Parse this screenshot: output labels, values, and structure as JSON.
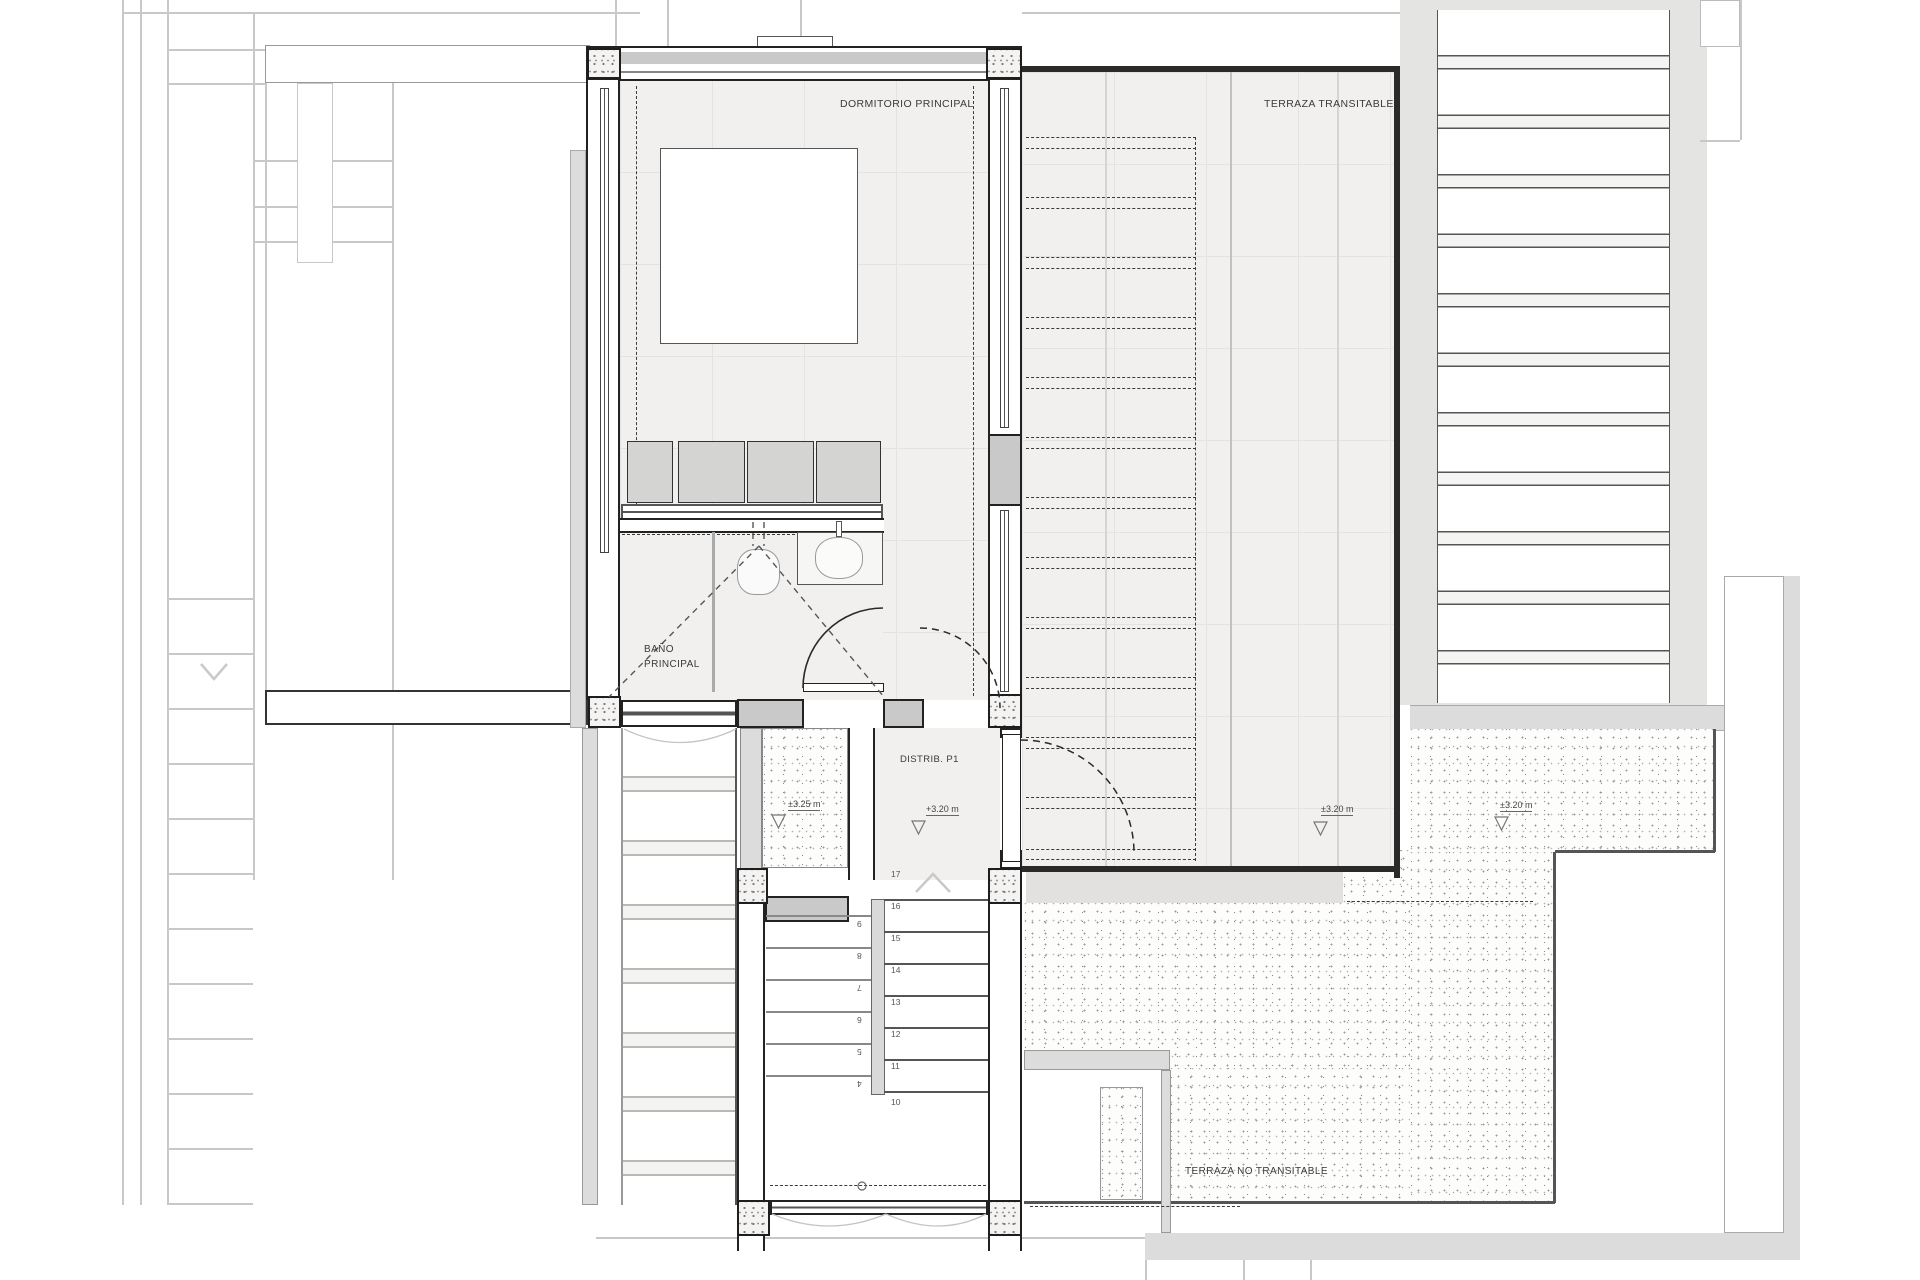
{
  "colors": {
    "wall_dark": "#2a2a2a",
    "wall_gray": "#c9c9c9",
    "floor_fill": "#f1f0ef",
    "context_line": "#c8c8c8",
    "stipple_bg": "#fdfdfc"
  },
  "rooms": {
    "bedroom": {
      "label": "DORMITORIO PRINCIPAL"
    },
    "terrace": {
      "label": "TERRAZA TRANSITABLE",
      "level": "±3.20 m"
    },
    "bathroom": {
      "label_line1": "BAÑO",
      "label_line2": "PRINCIPAL"
    },
    "distributor": {
      "label": "DISTRIB. P1",
      "level": "+3.20 m"
    },
    "stair_void": {
      "level": "±3.25 m"
    },
    "lower_terrace": {
      "label": "TERRAZA NO TRANSITABLE",
      "level": "±3.20 m"
    }
  },
  "stairs": {
    "up_flight": [
      "17",
      "16",
      "15",
      "14",
      "13",
      "12",
      "11",
      "10"
    ],
    "down_flight": [
      "9",
      "8",
      "7",
      "6",
      "5",
      "4"
    ]
  }
}
